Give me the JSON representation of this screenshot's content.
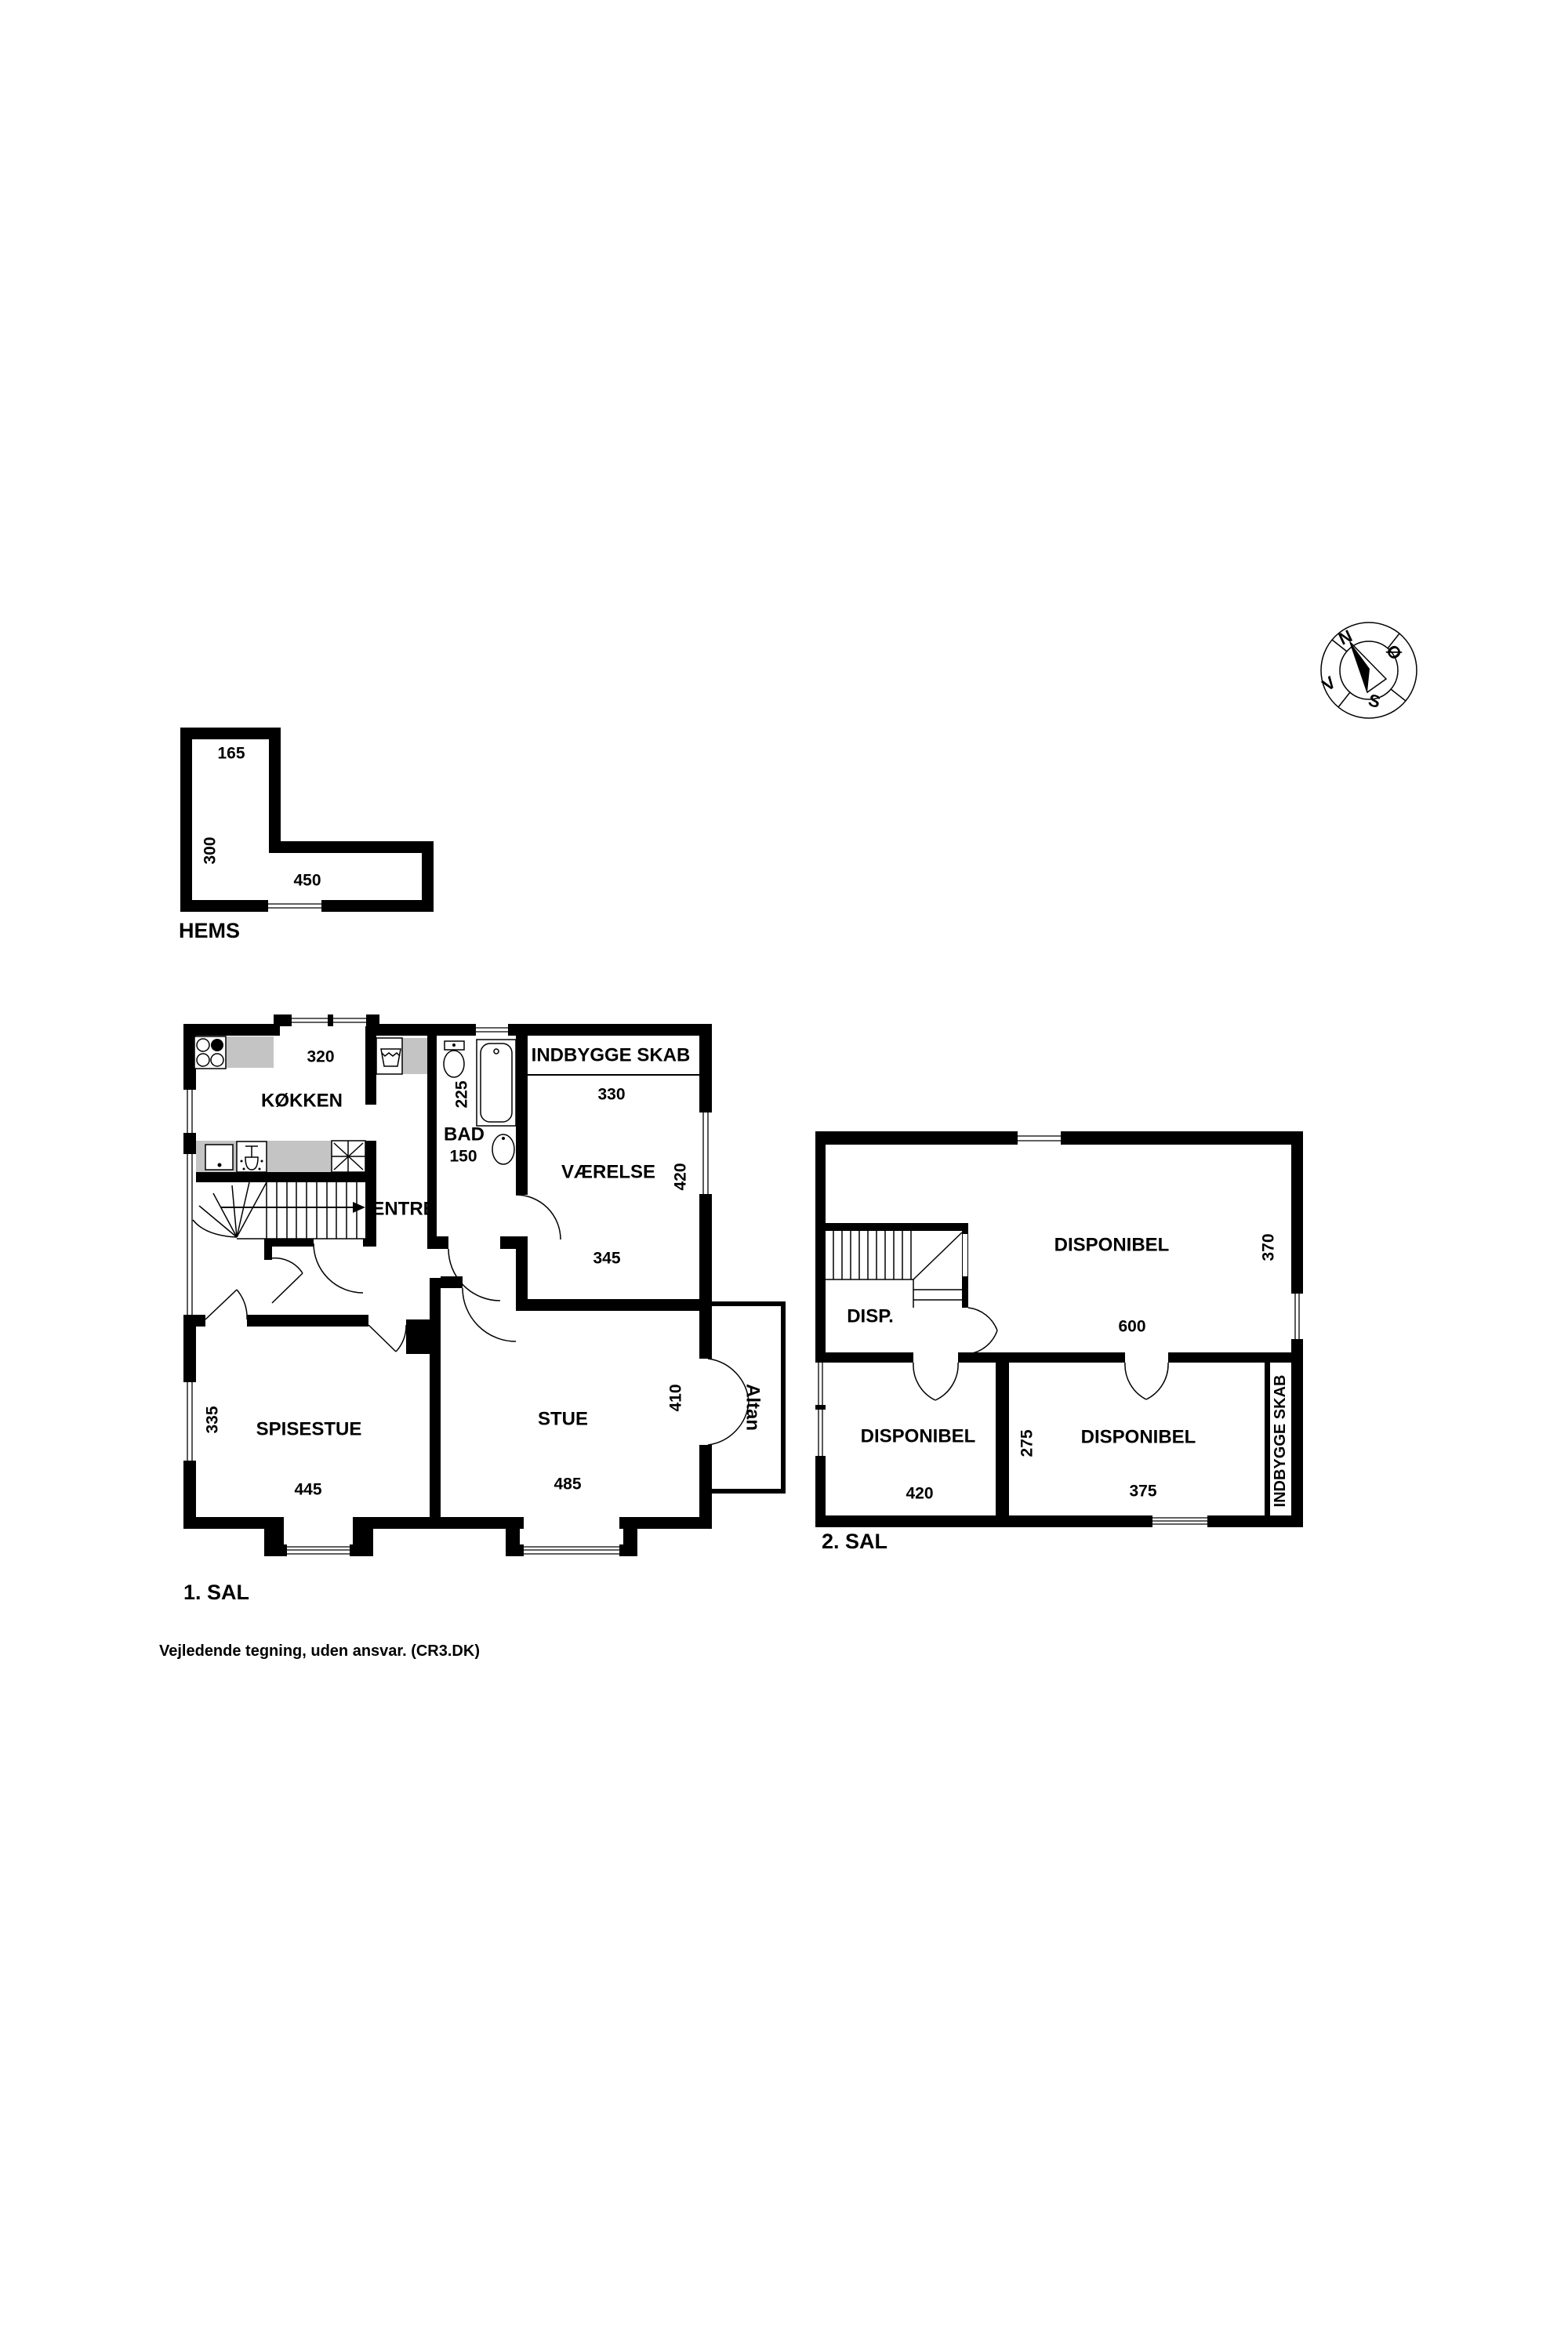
{
  "page": {
    "background": "#ffffff",
    "wall_color": "#000000",
    "counter_color": "#c4c4c4",
    "footer_note": "Vejledende tegning, uden ansvar. (CR3.DK)"
  },
  "compass": {
    "north": "N",
    "east": "Ø",
    "south": "S",
    "west": "V"
  },
  "hems": {
    "name": "HEMS",
    "dim_top": "165",
    "dim_left": "300",
    "dim_bottom": "450"
  },
  "floor1": {
    "name": "1. SAL",
    "kokken": {
      "label": "KØKKEN",
      "dim_top": "320"
    },
    "entre": {
      "label": "ENTRÉ"
    },
    "bad": {
      "label": "BAD",
      "dim_height": "225",
      "dim_width": "150"
    },
    "indbygge_skab": {
      "label": "INDBYGGE SKAB"
    },
    "vaerelse": {
      "label": "VÆRELSE",
      "dim_top": "330",
      "dim_right": "420",
      "dim_bottom": "345"
    },
    "spisestue": {
      "label": "SPISESTUE",
      "dim_left": "335",
      "dim_bottom": "445"
    },
    "stue": {
      "label": "STUE",
      "dim_right": "410",
      "dim_bottom": "485"
    },
    "altan": {
      "label": "Altan"
    }
  },
  "floor2": {
    "name": "2. SAL",
    "disponibel_top": {
      "label": "DISPONIBEL",
      "dim_right": "370",
      "dim_bottom": "600"
    },
    "disp": {
      "label": "DISP."
    },
    "disponibel_left": {
      "label": "DISPONIBEL",
      "dim_bottom": "420"
    },
    "disponibel_right": {
      "label": "DISPONIBEL",
      "dim_left": "275",
      "dim_bottom": "375"
    },
    "indbygge_skab": {
      "label": "INDBYGGE SKAB"
    }
  }
}
